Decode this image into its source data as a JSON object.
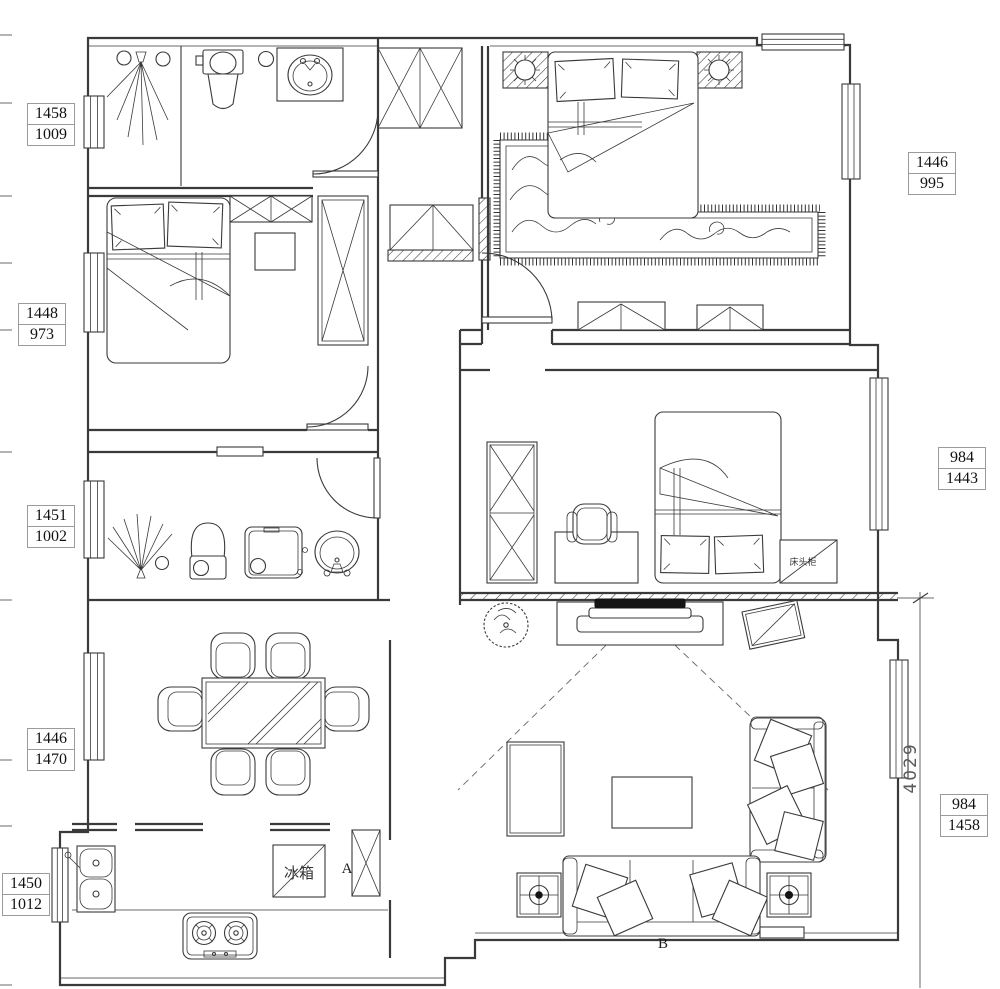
{
  "drawing": {
    "type": "apartment-floor-plan",
    "annotations": {
      "marker_a": "A",
      "marker_b": "B",
      "fridge_label": "冰箱",
      "nightstand_label": "床头柜",
      "vertical_dimension": "4029"
    },
    "dimension_labels": {
      "left": [
        {
          "top": "1458",
          "bottom": "1009"
        },
        {
          "top": "1448",
          "bottom": "973"
        },
        {
          "top": "1451",
          "bottom": "1002"
        },
        {
          "top": "1446",
          "bottom": "1470"
        },
        {
          "top": "1450",
          "bottom": "1012"
        }
      ],
      "right": [
        {
          "top": "1446",
          "bottom": "995"
        },
        {
          "top": "984",
          "bottom": "1443"
        },
        {
          "top": "984",
          "bottom": "1458"
        }
      ]
    }
  }
}
